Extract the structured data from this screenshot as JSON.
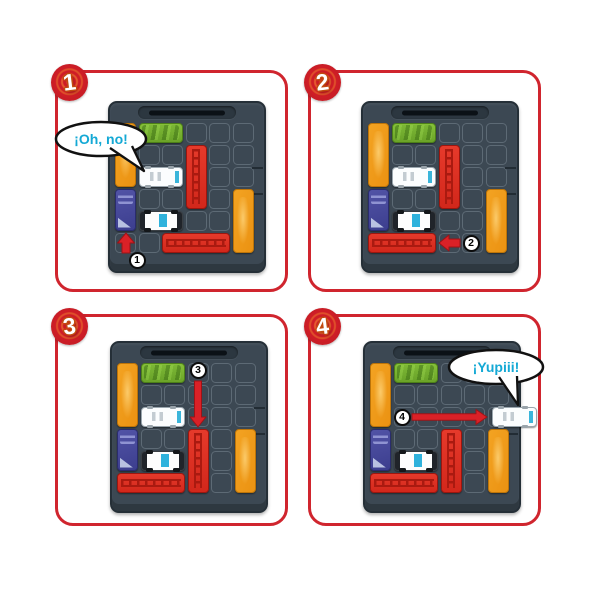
{
  "title": "sliding-puzzle-instruction-steps",
  "colors": {
    "panel_border": "#d0252e",
    "corner_badge_red": "#ce1d26",
    "speech_text": "#14a9d5",
    "arrow_red": "#da2127",
    "arrow_edge": "#9e1216",
    "board": "#3c4853",
    "orange_piece": "#f09d1d",
    "green_piece": "#79b52c",
    "red_piece": "#dd2e20",
    "blue_piece": "#47499c",
    "hero_truck": "#ffffff"
  },
  "board_grid": {
    "cols": 6,
    "rows": 6
  },
  "steps": [
    {
      "number": "1",
      "speech": {
        "text": "¡Oh, no!",
        "cx": 43,
        "cy": 66,
        "rx": 45,
        "ry": 17,
        "text_x": 43,
        "text_y": 71,
        "tail": "M 52 75 L 86 98 L 74 73"
      },
      "move": {
        "label": "1",
        "direction": "up",
        "arrow": {
          "from": [
            16,
            150
          ],
          "to": [
            16,
            130
          ],
          "shaft": 8,
          "head_w": 17,
          "head_l": 10
        },
        "badge_center": [
          27,
          157
        ]
      },
      "pieces": [
        {
          "type": "orange-block",
          "col": 0,
          "row": 0,
          "w": 1,
          "h": 3
        },
        {
          "type": "green-bus",
          "col": 1,
          "row": 0,
          "w": 2,
          "h": 1
        },
        {
          "type": "red-truck",
          "col": 3,
          "row": 1,
          "w": 1,
          "h": 3
        },
        {
          "type": "ice-cream-truck",
          "col": 1,
          "row": 2,
          "w": 2,
          "h": 1
        },
        {
          "type": "blue-car",
          "col": 0,
          "row": 3,
          "w": 1,
          "h": 2
        },
        {
          "type": "police-car",
          "col": 1,
          "row": 4,
          "w": 2,
          "h": 1
        },
        {
          "type": "red-truck",
          "col": 2,
          "row": 5,
          "w": 3,
          "h": 1
        },
        {
          "type": "orange-block",
          "col": 5,
          "row": 3,
          "w": 1,
          "h": 3
        }
      ]
    },
    {
      "number": "2",
      "speech": null,
      "move": {
        "label": "2",
        "direction": "left",
        "arrow": {
          "from": [
            97,
            140
          ],
          "to": [
            76,
            140
          ],
          "shaft": 8,
          "head_w": 16,
          "head_l": 10
        },
        "badge_center": [
          108,
          140
        ]
      },
      "pieces": [
        {
          "type": "orange-block",
          "col": 0,
          "row": 0,
          "w": 1,
          "h": 3
        },
        {
          "type": "green-bus",
          "col": 1,
          "row": 0,
          "w": 2,
          "h": 1
        },
        {
          "type": "red-truck",
          "col": 3,
          "row": 1,
          "w": 1,
          "h": 3
        },
        {
          "type": "ice-cream-truck",
          "col": 1,
          "row": 2,
          "w": 2,
          "h": 1
        },
        {
          "type": "blue-car",
          "col": 0,
          "row": 3,
          "w": 1,
          "h": 2
        },
        {
          "type": "police-car",
          "col": 1,
          "row": 4,
          "w": 2,
          "h": 1
        },
        {
          "type": "red-truck",
          "col": 0,
          "row": 5,
          "w": 3,
          "h": 1
        },
        {
          "type": "orange-block",
          "col": 5,
          "row": 3,
          "w": 1,
          "h": 3
        }
      ]
    },
    {
      "number": "3",
      "speech": null,
      "move": {
        "label": "3",
        "direction": "down",
        "arrow": {
          "from": [
            86,
            38
          ],
          "to": [
            86,
            84
          ],
          "shaft": 7,
          "head_w": 16,
          "head_l": 10
        },
        "badge_center": [
          86,
          27
        ]
      },
      "pieces": [
        {
          "type": "orange-block",
          "col": 0,
          "row": 0,
          "w": 1,
          "h": 3
        },
        {
          "type": "green-bus",
          "col": 1,
          "row": 0,
          "w": 2,
          "h": 1
        },
        {
          "type": "ice-cream-truck",
          "col": 1,
          "row": 2,
          "w": 2,
          "h": 1
        },
        {
          "type": "blue-car",
          "col": 0,
          "row": 3,
          "w": 1,
          "h": 2
        },
        {
          "type": "police-car",
          "col": 1,
          "row": 4,
          "w": 2,
          "h": 1
        },
        {
          "type": "red-truck",
          "col": 0,
          "row": 5,
          "w": 3,
          "h": 1
        },
        {
          "type": "red-truck",
          "col": 3,
          "row": 3,
          "w": 1,
          "h": 3
        },
        {
          "type": "orange-block",
          "col": 5,
          "row": 3,
          "w": 1,
          "h": 3
        }
      ]
    },
    {
      "number": "4",
      "speech": {
        "text": "¡Yupiii!",
        "cx": 185,
        "cy": 50,
        "rx": 47,
        "ry": 17,
        "text_x": 185,
        "text_y": 55,
        "tail": "M 188 60 L 207 88 L 206 59"
      },
      "move": {
        "label": "4",
        "direction": "right",
        "arrow": {
          "from": [
            47,
            74
          ],
          "to": [
            122,
            74
          ],
          "shaft": 6.5,
          "head_w": 15,
          "head_l": 11
        },
        "badge_center": [
          37,
          74
        ]
      },
      "pieces": [
        {
          "type": "orange-block",
          "col": 0,
          "row": 0,
          "w": 1,
          "h": 3
        },
        {
          "type": "green-bus",
          "col": 1,
          "row": 0,
          "w": 2,
          "h": 1
        },
        {
          "type": "blue-car",
          "col": 0,
          "row": 3,
          "w": 1,
          "h": 2
        },
        {
          "type": "police-car",
          "col": 1,
          "row": 4,
          "w": 2,
          "h": 1
        },
        {
          "type": "red-truck",
          "col": 0,
          "row": 5,
          "w": 3,
          "h": 1
        },
        {
          "type": "red-truck",
          "col": 3,
          "row": 3,
          "w": 1,
          "h": 3
        },
        {
          "type": "orange-block",
          "col": 5,
          "row": 3,
          "w": 1,
          "h": 3
        },
        {
          "type": "ice-cream-truck",
          "col": 5.2,
          "row": 2,
          "w": 2,
          "h": 1,
          "exiting": true
        }
      ]
    }
  ]
}
